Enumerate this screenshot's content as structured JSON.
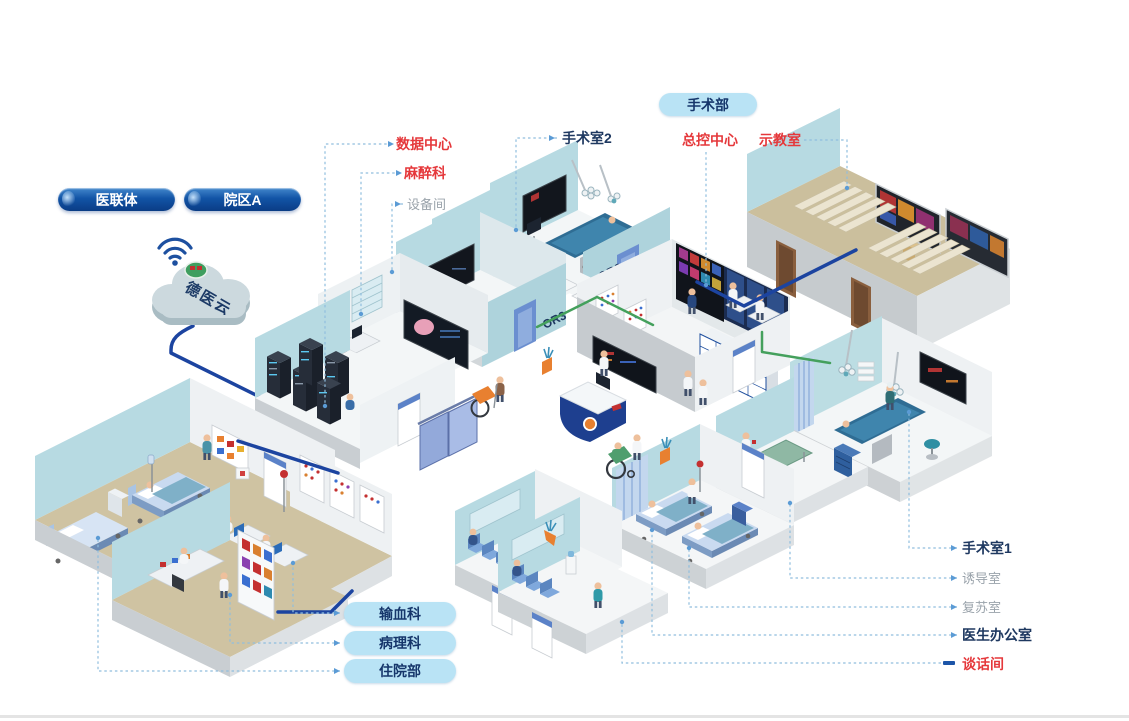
{
  "canvas": {
    "width": 1129,
    "height": 721,
    "background": "#ffffff",
    "bottom_edge_color": "#e4e4e4"
  },
  "colors": {
    "label_red": "#e5383b",
    "label_dark": "#1e3860",
    "label_gray": "#9aa3ab",
    "pill_light_bg": "#b9e3f5",
    "pill_navy_dark": "#0a3c85",
    "pill_navy_light": "#4388cc",
    "leader_blue": "#90bede",
    "backbone_navy": "#1c44a0",
    "lan_green": "#44a05c",
    "wall_blue": "#b7dae2",
    "floor_tan": "#cfc3a2",
    "accent_orange": "#e88030",
    "accent_red": "#c43030"
  },
  "cloud": {
    "label": "德医云"
  },
  "org_pills": [
    {
      "label": "医联体"
    },
    {
      "label": "院区A"
    }
  ],
  "area_pill": {
    "label": "手术部"
  },
  "labels": {
    "data_center": {
      "text": "数据中心",
      "style": "red"
    },
    "anesthesiology": {
      "text": "麻醉科",
      "style": "red"
    },
    "equipment_room": {
      "text": "设备间",
      "style": "gray"
    },
    "operating_room_2": {
      "text": "手术室2",
      "style": "dark"
    },
    "master_control": {
      "text": "总控中心",
      "style": "red"
    },
    "demo_classroom": {
      "text": "示教室",
      "style": "red"
    },
    "operating_room_1": {
      "text": "手术室1",
      "style": "dark"
    },
    "induction_room": {
      "text": "诱导室",
      "style": "gray"
    },
    "recovery_room": {
      "text": "复苏室",
      "style": "gray"
    },
    "doctor_office": {
      "text": "医生办公室",
      "style": "dark"
    },
    "talk_room": {
      "text": "谈话间",
      "style": "red"
    }
  },
  "dept_pills": [
    {
      "label": "输血科"
    },
    {
      "label": "病理科"
    },
    {
      "label": "住院部"
    }
  ],
  "wall_marks": {
    "or2": "OR2",
    "or3": "OR3"
  }
}
